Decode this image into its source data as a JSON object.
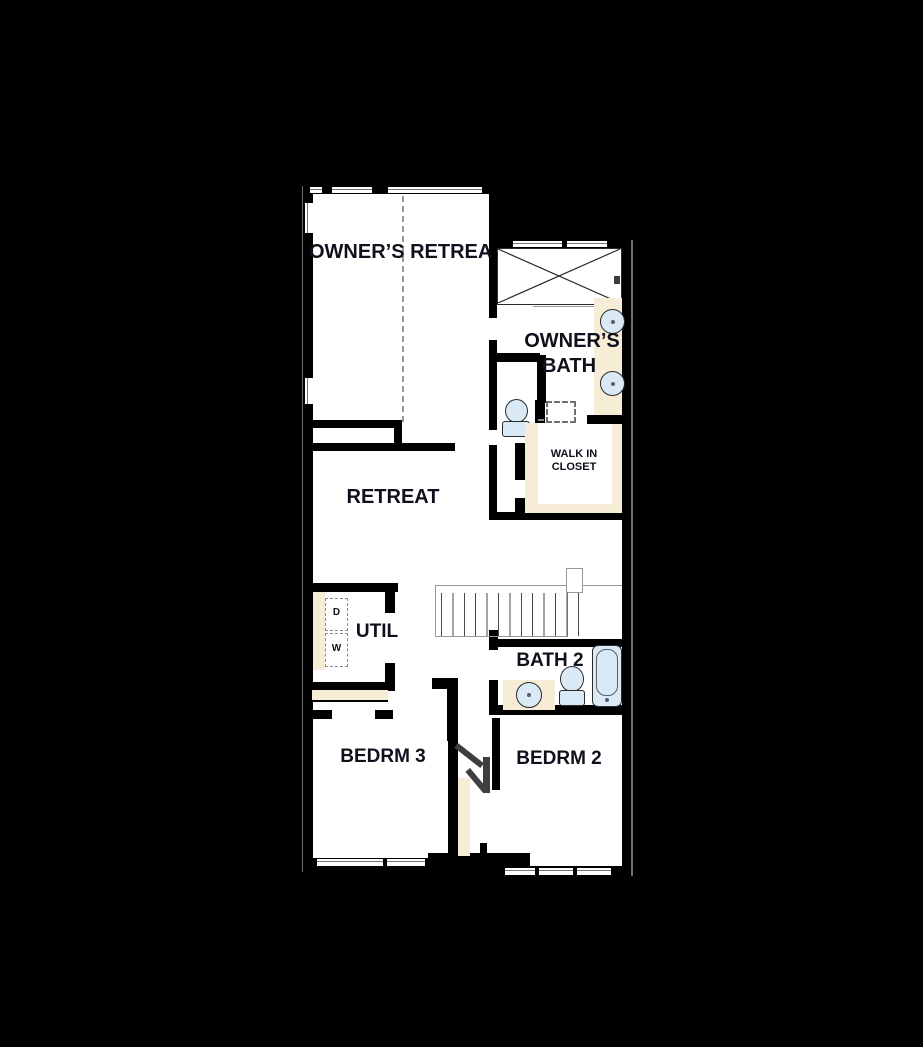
{
  "document": {
    "type": "residential second floor plan"
  },
  "colors": {
    "bg": "#000000",
    "floor": "#ffffff",
    "wall": "#000000",
    "counter": "#f7ecd6",
    "fixture": "#d9e9f5",
    "fixture_border": "#2b2b2b",
    "label": "#10101c",
    "line": "#8a8a8a"
  },
  "rooms": {
    "owners_retreat": {
      "label": "OWNER’S RETREAT"
    },
    "owners_bath": {
      "line1": "OWNER’S",
      "line2": "BATH"
    },
    "walk_in_closet": {
      "line1": "WALK IN",
      "line2": "CLOSET"
    },
    "retreat": {
      "label": "RETREAT"
    },
    "util": {
      "label": "UTIL"
    },
    "bath_2": {
      "label": "BATH 2"
    },
    "bedroom_3": {
      "label": "BEDRM 3"
    },
    "bedroom_2": {
      "label": "BEDRM 2"
    }
  },
  "appliances": {
    "dryer_label": "D",
    "washer_label": "W"
  }
}
